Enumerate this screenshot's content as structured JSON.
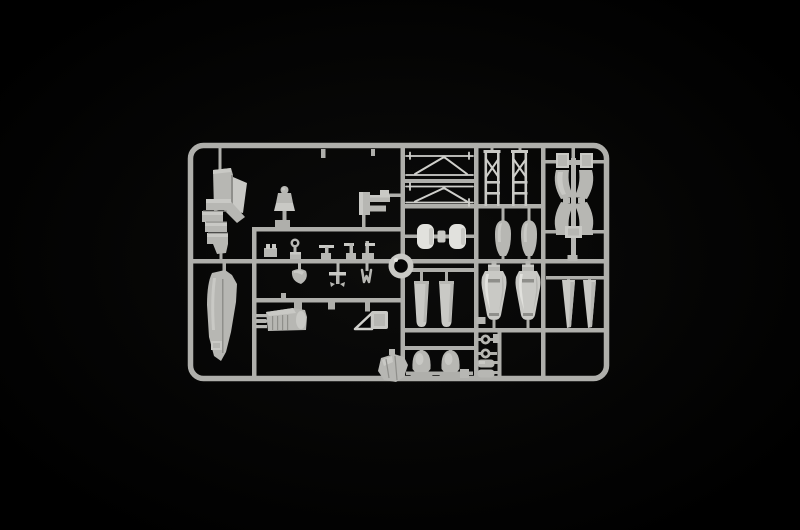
{
  "scene": {
    "description": "Light grey injection-moulded plastic model kit sprue (parts tree) with aircraft parts, photographed on a black background"
  },
  "colors": {
    "background": "#000000",
    "glow": "#0c0c0b",
    "rail": "#afafab",
    "part": "#b7b7b3",
    "part_light": "#c9c9c5",
    "part_bright": "#e1e1dd",
    "part_dark": "#8f8f8b",
    "part_shadow": "#6e6e6a",
    "strut": "#cfcfcb",
    "hole": "#040404"
  },
  "sprue": {
    "material": "light grey polystyrene",
    "part_names": [
      "fuselage-sidewall-assembly",
      "fuselage-half",
      "pilot-figure",
      "engine-bracket",
      "cockpit-levers",
      "control-linkages",
      "engine-block",
      "windscreen-frame",
      "wing-strut-pairs",
      "cross-braced-struts",
      "seat-cushions",
      "wheel-spat-halves",
      "undercarriage-frame",
      "exhaust-fairings",
      "drop-tank-halves",
      "propeller-blades",
      "wheel-halves",
      "locating-rings-and-pins",
      "alignment-ring",
      "cowling-piece"
    ]
  }
}
